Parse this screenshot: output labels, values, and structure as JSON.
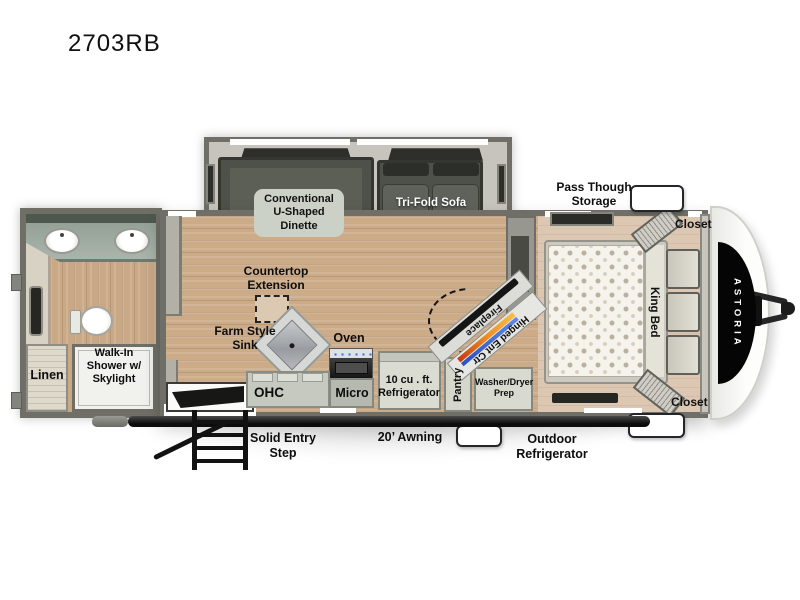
{
  "title": "2703RB",
  "brand_decal": "ASTORIA",
  "labels": {
    "dinette": "Conventional\nU-Shaped\nDinette",
    "sofa": "Tri-Fold Sofa",
    "pass_storage": "Pass Though\nStorage",
    "closet_top": "Closet",
    "closet_bottom": "Closet",
    "king_bed": "King Bed",
    "countertop_ext": "Countertop\nExtension",
    "farm_sink": "Farm Style\nSink",
    "oven": "Oven",
    "ohc": "OHC",
    "micro": "Micro",
    "refrigerator": "10 cu . ft.\nRefrigerator",
    "pantry": "Pantry",
    "washer_dryer": "Washer/Dryer\nPrep",
    "fireplace": "Fireplace",
    "hinged_ent": "Hinged Ent Ctr",
    "linen": "Linen",
    "shower": "Walk-In\nShower w/\nSkylight",
    "entry_step": "Solid Entry\nStep",
    "awning": "20’ Awning",
    "outdoor_fridge": "Outdoor\nRefrigerator"
  },
  "colors": {
    "wall_gray": "#6f6f68",
    "slide_interior": "#c7c4bd",
    "furniture_dark": "#4e5149",
    "floor_wood": "#cbab88",
    "floor_bedroom": "#dcc7b2",
    "flame_orange": "#ef8b1d",
    "flame_blue": "#3d63cd",
    "decal_black": "#050505"
  }
}
